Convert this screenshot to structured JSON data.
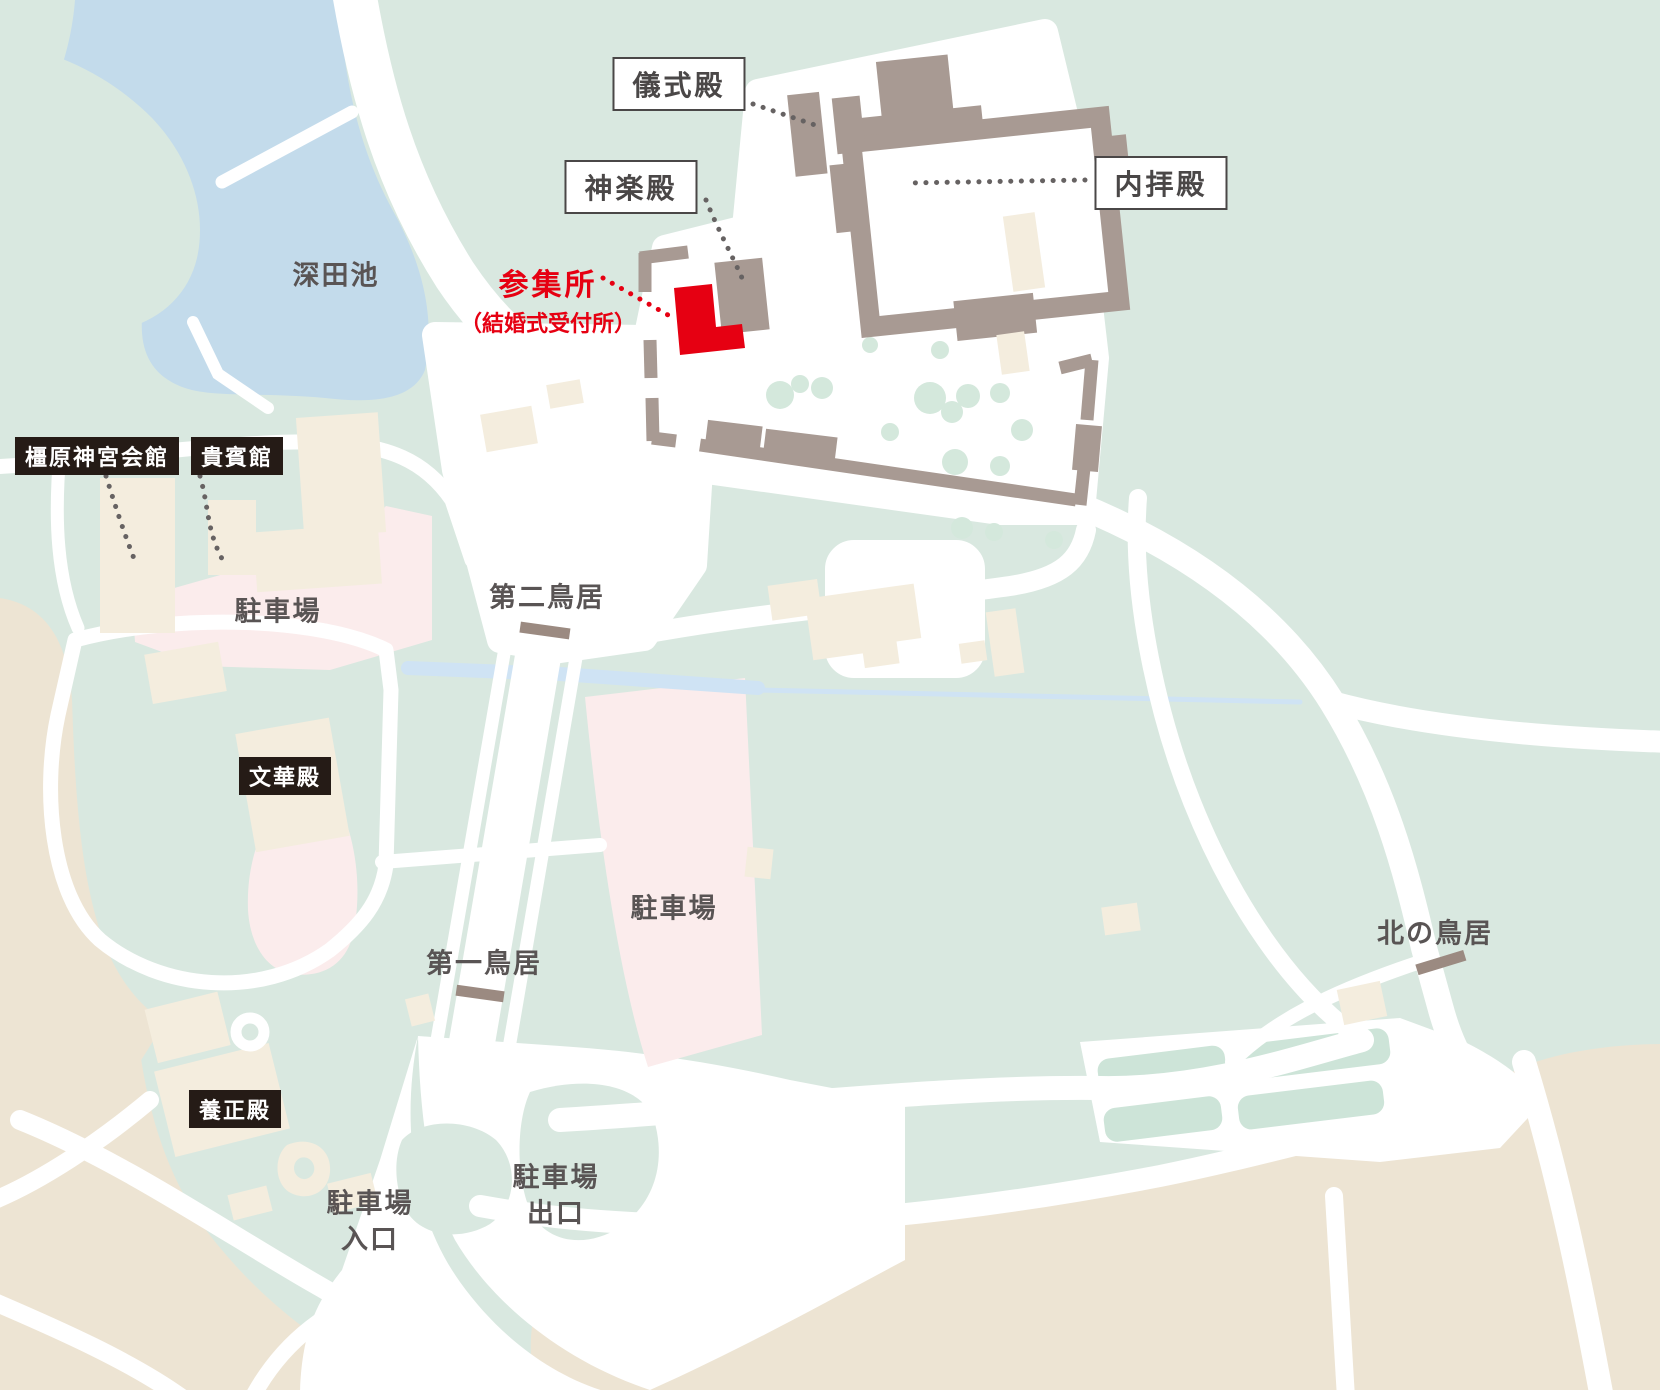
{
  "map": {
    "boxed_callouts": [
      {
        "id": "gishikiden",
        "label": "儀式殿"
      },
      {
        "id": "kaguraden",
        "label": "神楽殿"
      },
      {
        "id": "naihaiden",
        "label": "内拝殿"
      }
    ],
    "highlight_callout": {
      "label": "参集所",
      "sublabel": "（結婚式受付所）"
    },
    "badges": [
      {
        "id": "kashihara-kaikan",
        "label": "橿原神宮会館"
      },
      {
        "id": "kihinkan",
        "label": "貴賓館"
      },
      {
        "id": "bunkaden",
        "label": "文華殿"
      },
      {
        "id": "yoseiden",
        "label": "養正殿"
      }
    ],
    "place_labels": [
      {
        "id": "fukada-pond",
        "label": "深田池"
      },
      {
        "id": "parking-west",
        "label": "駐車場"
      },
      {
        "id": "second-torii",
        "label": "第二鳥居"
      },
      {
        "id": "parking-sando",
        "label": "駐車場"
      },
      {
        "id": "first-torii",
        "label": "第一鳥居"
      },
      {
        "id": "north-torii",
        "label": "北の鳥居"
      }
    ],
    "two_line_labels": [
      {
        "id": "parking-entrance",
        "line1": "駐車場",
        "line2": "入口"
      },
      {
        "id": "parking-exit",
        "line1": "駐車場",
        "line2": "出口"
      }
    ],
    "colors": {
      "background_green": "#d9e8e0",
      "ground_tan": "#ede4d3",
      "pond_blue": "#c3dbeb",
      "stream_blue": "#cfe3f4",
      "building_beige": "#f4edde",
      "parking_pink": "#fbecec",
      "wall_taupe": "#a89a93",
      "torii_brown": "#9b8a81",
      "highlight_red": "#e60012",
      "tree_green": "#d4e8dc",
      "label_gray": "#595454",
      "badge_black": "#251b16"
    }
  }
}
